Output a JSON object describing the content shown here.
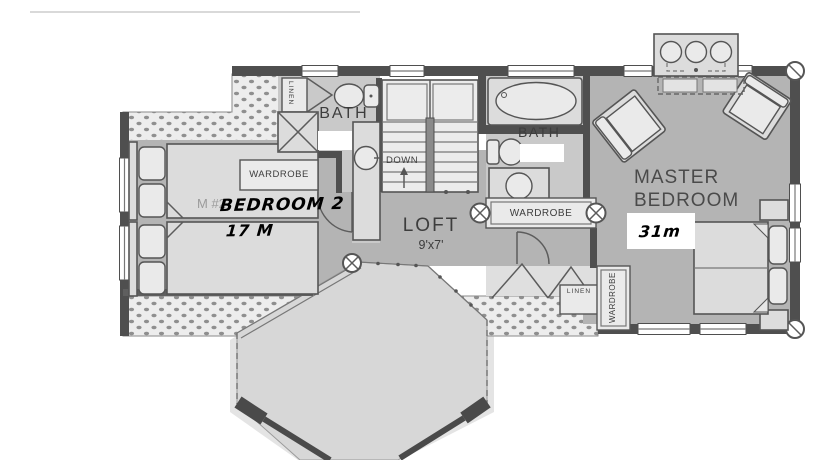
{
  "colors": {
    "wall": "#4f4f4f",
    "room_fill": "#b4b4b4",
    "bath_fill": "#c9c9c9",
    "octagon_fill": "#d7d7d7",
    "roof_dots_bg": "#ededed",
    "fixture_fill": "#dcdcdc",
    "fixture_light": "#eaeaea",
    "label_ink": "#3d3d3d",
    "annotation_ink": "#000000",
    "patch": "#ffffff"
  },
  "labels": {
    "bath_left": "BATH",
    "bath_right": "BATH",
    "linen_left": "LINEN",
    "linen_right": "LINEN",
    "wardrobe_bedroom2": "WARDROBE",
    "wardrobe_hall": "WARDROBE",
    "wardrobe_master": "WARDROBE",
    "loft": "LOFT",
    "loft_size": "9'x7'",
    "stairs_down": "DOWN",
    "master_bedroom": "MASTER\nBEDROOM",
    "bedroom2_fragment": "M #2"
  },
  "annotations": {
    "bedroom2_name": "BEDROOM 2",
    "bedroom2_area": "17 M",
    "master_area": "31m"
  }
}
